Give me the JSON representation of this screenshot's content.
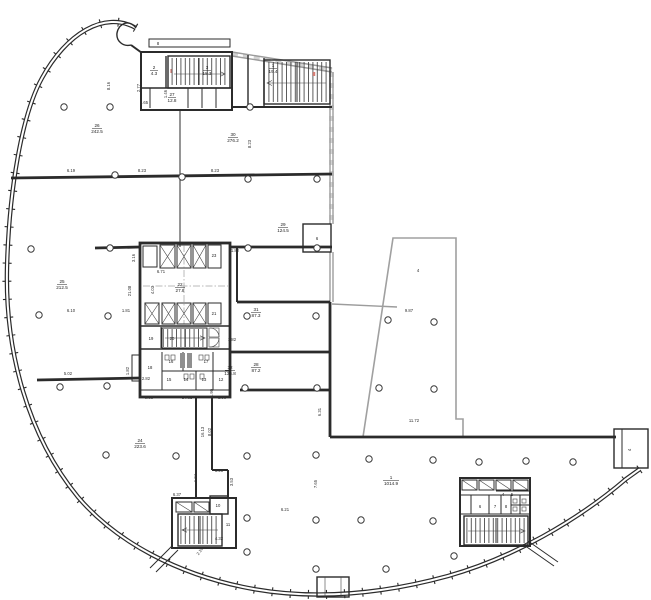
{
  "drawing_type": "architectural floor plan",
  "colors": {
    "wall": "#2b2b2b",
    "light_wall": "#9c9c9c",
    "stair_mark_red": "#c0392b",
    "paper": "#ffffff"
  },
  "rooms": {
    "r26": {
      "num": "26",
      "area": "242.5"
    },
    "r30": {
      "num": "30",
      "area": "276.2"
    },
    "r29": {
      "num": "29",
      "area": "124.5"
    },
    "r25": {
      "num": "25",
      "area": "212.5"
    },
    "r31": {
      "num": "31",
      "area": "87.3"
    },
    "r28": {
      "num": "28",
      "area": "87.2"
    },
    "r32": {
      "num": "32",
      "area": "136.8"
    },
    "r22": {
      "num": "22",
      "area": "27.8"
    },
    "r24": {
      "num": "24",
      "area": "223.6"
    },
    "r1": {
      "num": "1",
      "area": "1014.9"
    },
    "r2": {
      "num": "2",
      "area": "4.3"
    },
    "r3": {
      "num": "3",
      "area": "18.3"
    },
    "r1s": {
      "num": "1",
      "area": "19.4"
    },
    "r27": {
      "num": "27",
      "area": "12.8"
    }
  },
  "small_rooms": {
    "k23": "23",
    "k21": "21",
    "k19": "19",
    "k20": "20",
    "k18": "18",
    "k17": "17",
    "k16": "16",
    "k15": "15",
    "k14": "14",
    "k13": "13",
    "k12": "12",
    "k11": "11",
    "k10": "10",
    "k6e": "6",
    "k4t": "4",
    "k4e": "4",
    "k8c": "8",
    "k6b": "6",
    "k7b": "7",
    "k8b": "8",
    "k4b": "4",
    "k5b": "5"
  },
  "stair_marks": {
    "s1": "I",
    "s2": "II"
  },
  "dims": {
    "d01": "8.16",
    "d02": "6.19",
    "d03": "8.23",
    "d04": "8.23",
    "d05": "8.23",
    "d06": "2.77",
    "d07": "5.65",
    "d08": "1.46",
    "d09": "6.10",
    "d10": "5.02",
    "d11": "1.81",
    "d12": "1.82",
    "d13": "1.82",
    "d14": "1.82",
    "d15": "3.16",
    "d16": "21.08",
    "d17": "6.71",
    "d18": "4.03",
    "d19": "2.82",
    "d20": "9.83",
    "d21": "14.81",
    "d22": "1.90",
    "d23": "3.98",
    "d24": "16.13",
    "d25": "8.02",
    "d26": "3.23",
    "d27": "1.94",
    "d28": "3.53",
    "d29": "6.37",
    "d30": "4.32",
    "d31": "2.19",
    "d32": "6.21",
    "d33": "7.65",
    "d34": "6.31",
    "d35": "9.87",
    "d36": "11.72"
  }
}
